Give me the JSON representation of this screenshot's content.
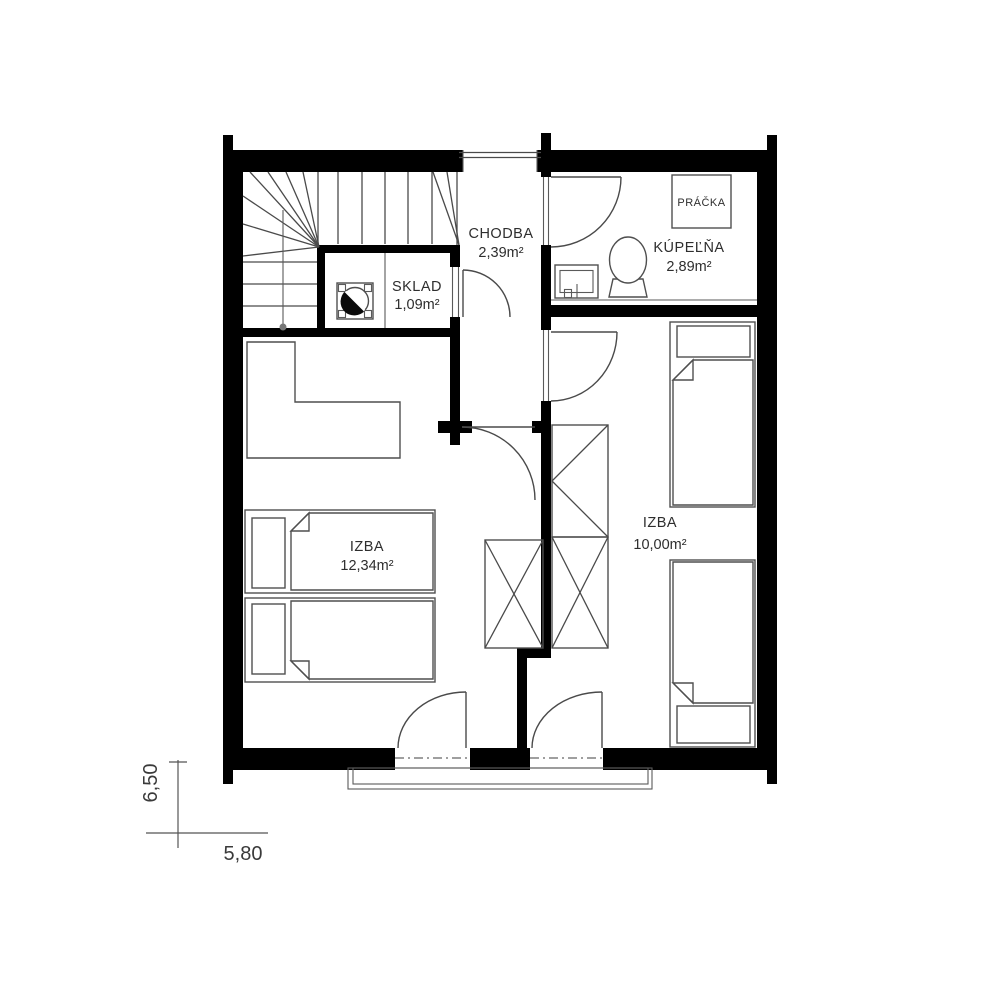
{
  "rooms": {
    "chodba": {
      "name": "CHODBA",
      "area": "2,39m²"
    },
    "kupelna": {
      "name": "KÚPEĽŇA",
      "area": "2,89m²"
    },
    "sklad": {
      "name": "SKLAD",
      "area": "1,09m²"
    },
    "izba_left": {
      "name": "IZBA",
      "area": "12,34m²"
    },
    "izba_right": {
      "name": "IZBA",
      "area": "10,00m²"
    }
  },
  "appliances": {
    "washer": "PRÁČKA"
  },
  "dimensions": {
    "horizontal": "5,80",
    "vertical": "6,50"
  },
  "colors": {
    "wall": "#000000",
    "line": "#4a4a4a",
    "text": "#2e2e2e",
    "background": "#ffffff"
  }
}
